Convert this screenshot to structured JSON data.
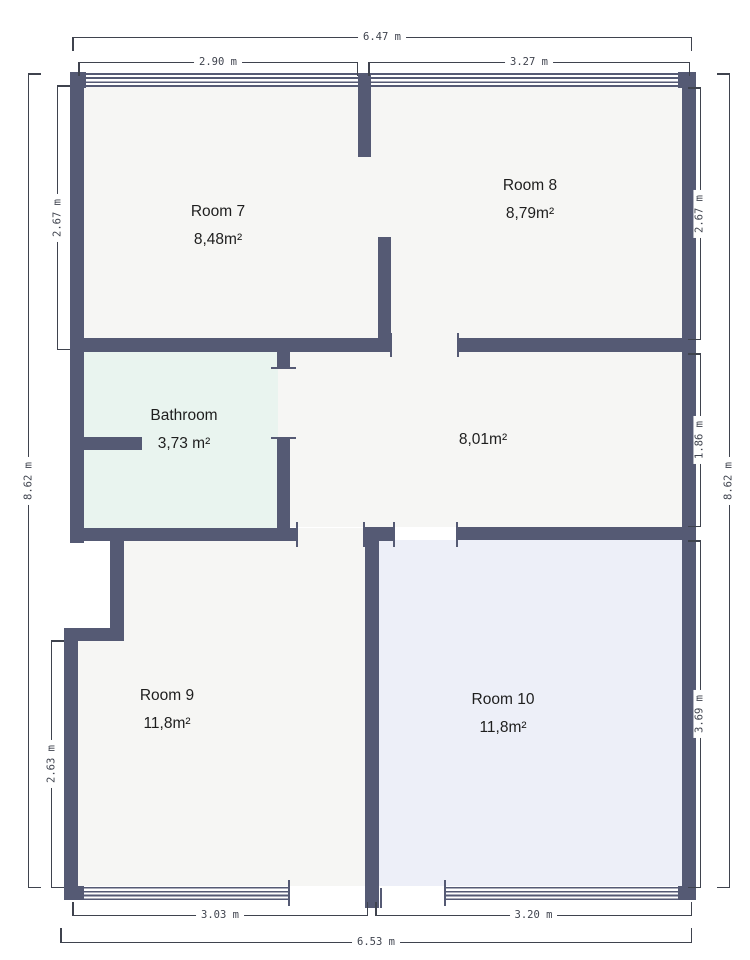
{
  "plan": {
    "title": "Floor plan",
    "rooms": [
      {
        "name": "Room 7",
        "area": "8,48m²"
      },
      {
        "name": "Room 8",
        "area": "8,79m²"
      },
      {
        "name": "Bathroom",
        "area": "3,73 m²"
      },
      {
        "name": "",
        "area": "8,01m²"
      },
      {
        "name": "Room 9",
        "area": "11,8m²"
      },
      {
        "name": "Room 10",
        "area": "11,8m²"
      }
    ],
    "dimensions": {
      "top_total": "6.47 m",
      "top_left": "2.90 m",
      "top_right": "3.27 m",
      "left_total": "8.62 m",
      "left_upper": "2.67 m",
      "left_lower": "2.63 m",
      "right_upper": "2.67 m",
      "right_middle": "1.86 m",
      "right_total": "8.62 m",
      "right_lower": "3.69 m",
      "bottom_left": "3.03 m",
      "bottom_right": "3.20 m",
      "bottom_total": "6.53 m"
    },
    "colors": {
      "wall": "#555a74",
      "floor": "#f6f6f4",
      "bathroom": "#e9f4ef",
      "room10": "#edeff8",
      "dim": "#3f434e",
      "label": "#1e1e1e",
      "bg": "#ffffff"
    }
  }
}
